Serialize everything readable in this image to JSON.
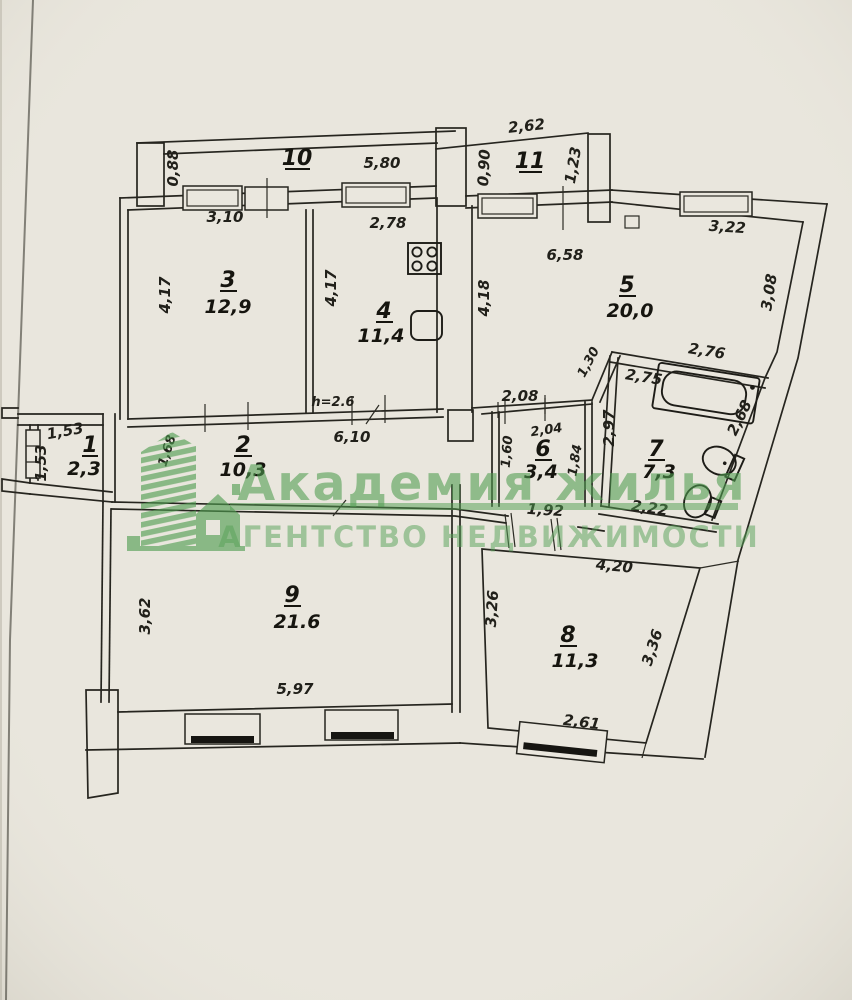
{
  "document": {
    "type_note": "scanned apartment floor plan",
    "paper_color": "#e9e6dd",
    "ink_color": "#26251f",
    "watermark_color": "#8cbc8a"
  },
  "watermark": {
    "brand": "Академия жилья",
    "agency": "АГЕНТСТВО НЕДВИЖИМОСТИ",
    "logo": "green-building-logo"
  },
  "plan": {
    "height_note": "h=2.6",
    "rooms": [
      {
        "num": "1",
        "area": "2,3"
      },
      {
        "num": "2",
        "area": "10,3"
      },
      {
        "num": "3",
        "area": "12,9"
      },
      {
        "num": "4",
        "area": "11,4"
      },
      {
        "num": "5",
        "area": "20,0"
      },
      {
        "num": "6",
        "area": "3,4"
      },
      {
        "num": "7",
        "area": "7,3"
      },
      {
        "num": "8",
        "area": "11,3"
      },
      {
        "num": "9",
        "area": "21.6"
      },
      {
        "num": "10",
        "area": ""
      },
      {
        "num": "11",
        "area": ""
      }
    ],
    "dims": [
      "0,88",
      "5,80",
      "2,62",
      "0,90",
      "1,23",
      "3,10",
      "2,78",
      "6,58",
      "3,22",
      "4,17",
      "4,17",
      "4,18",
      "3,08",
      "1,30",
      "2,76",
      "2,75",
      "2,08",
      "2,97",
      "2,68",
      "6,10",
      "2,04",
      "1,60",
      "1,84",
      "1,53",
      "1,53",
      "1,68",
      "1,92",
      "2,22",
      "3,62",
      "5,97",
      "3,26",
      "4,20",
      "3,36",
      "2,61"
    ],
    "fixtures": [
      "stove",
      "kitchen-sink",
      "bathtub",
      "wash-basin",
      "toilet"
    ]
  }
}
